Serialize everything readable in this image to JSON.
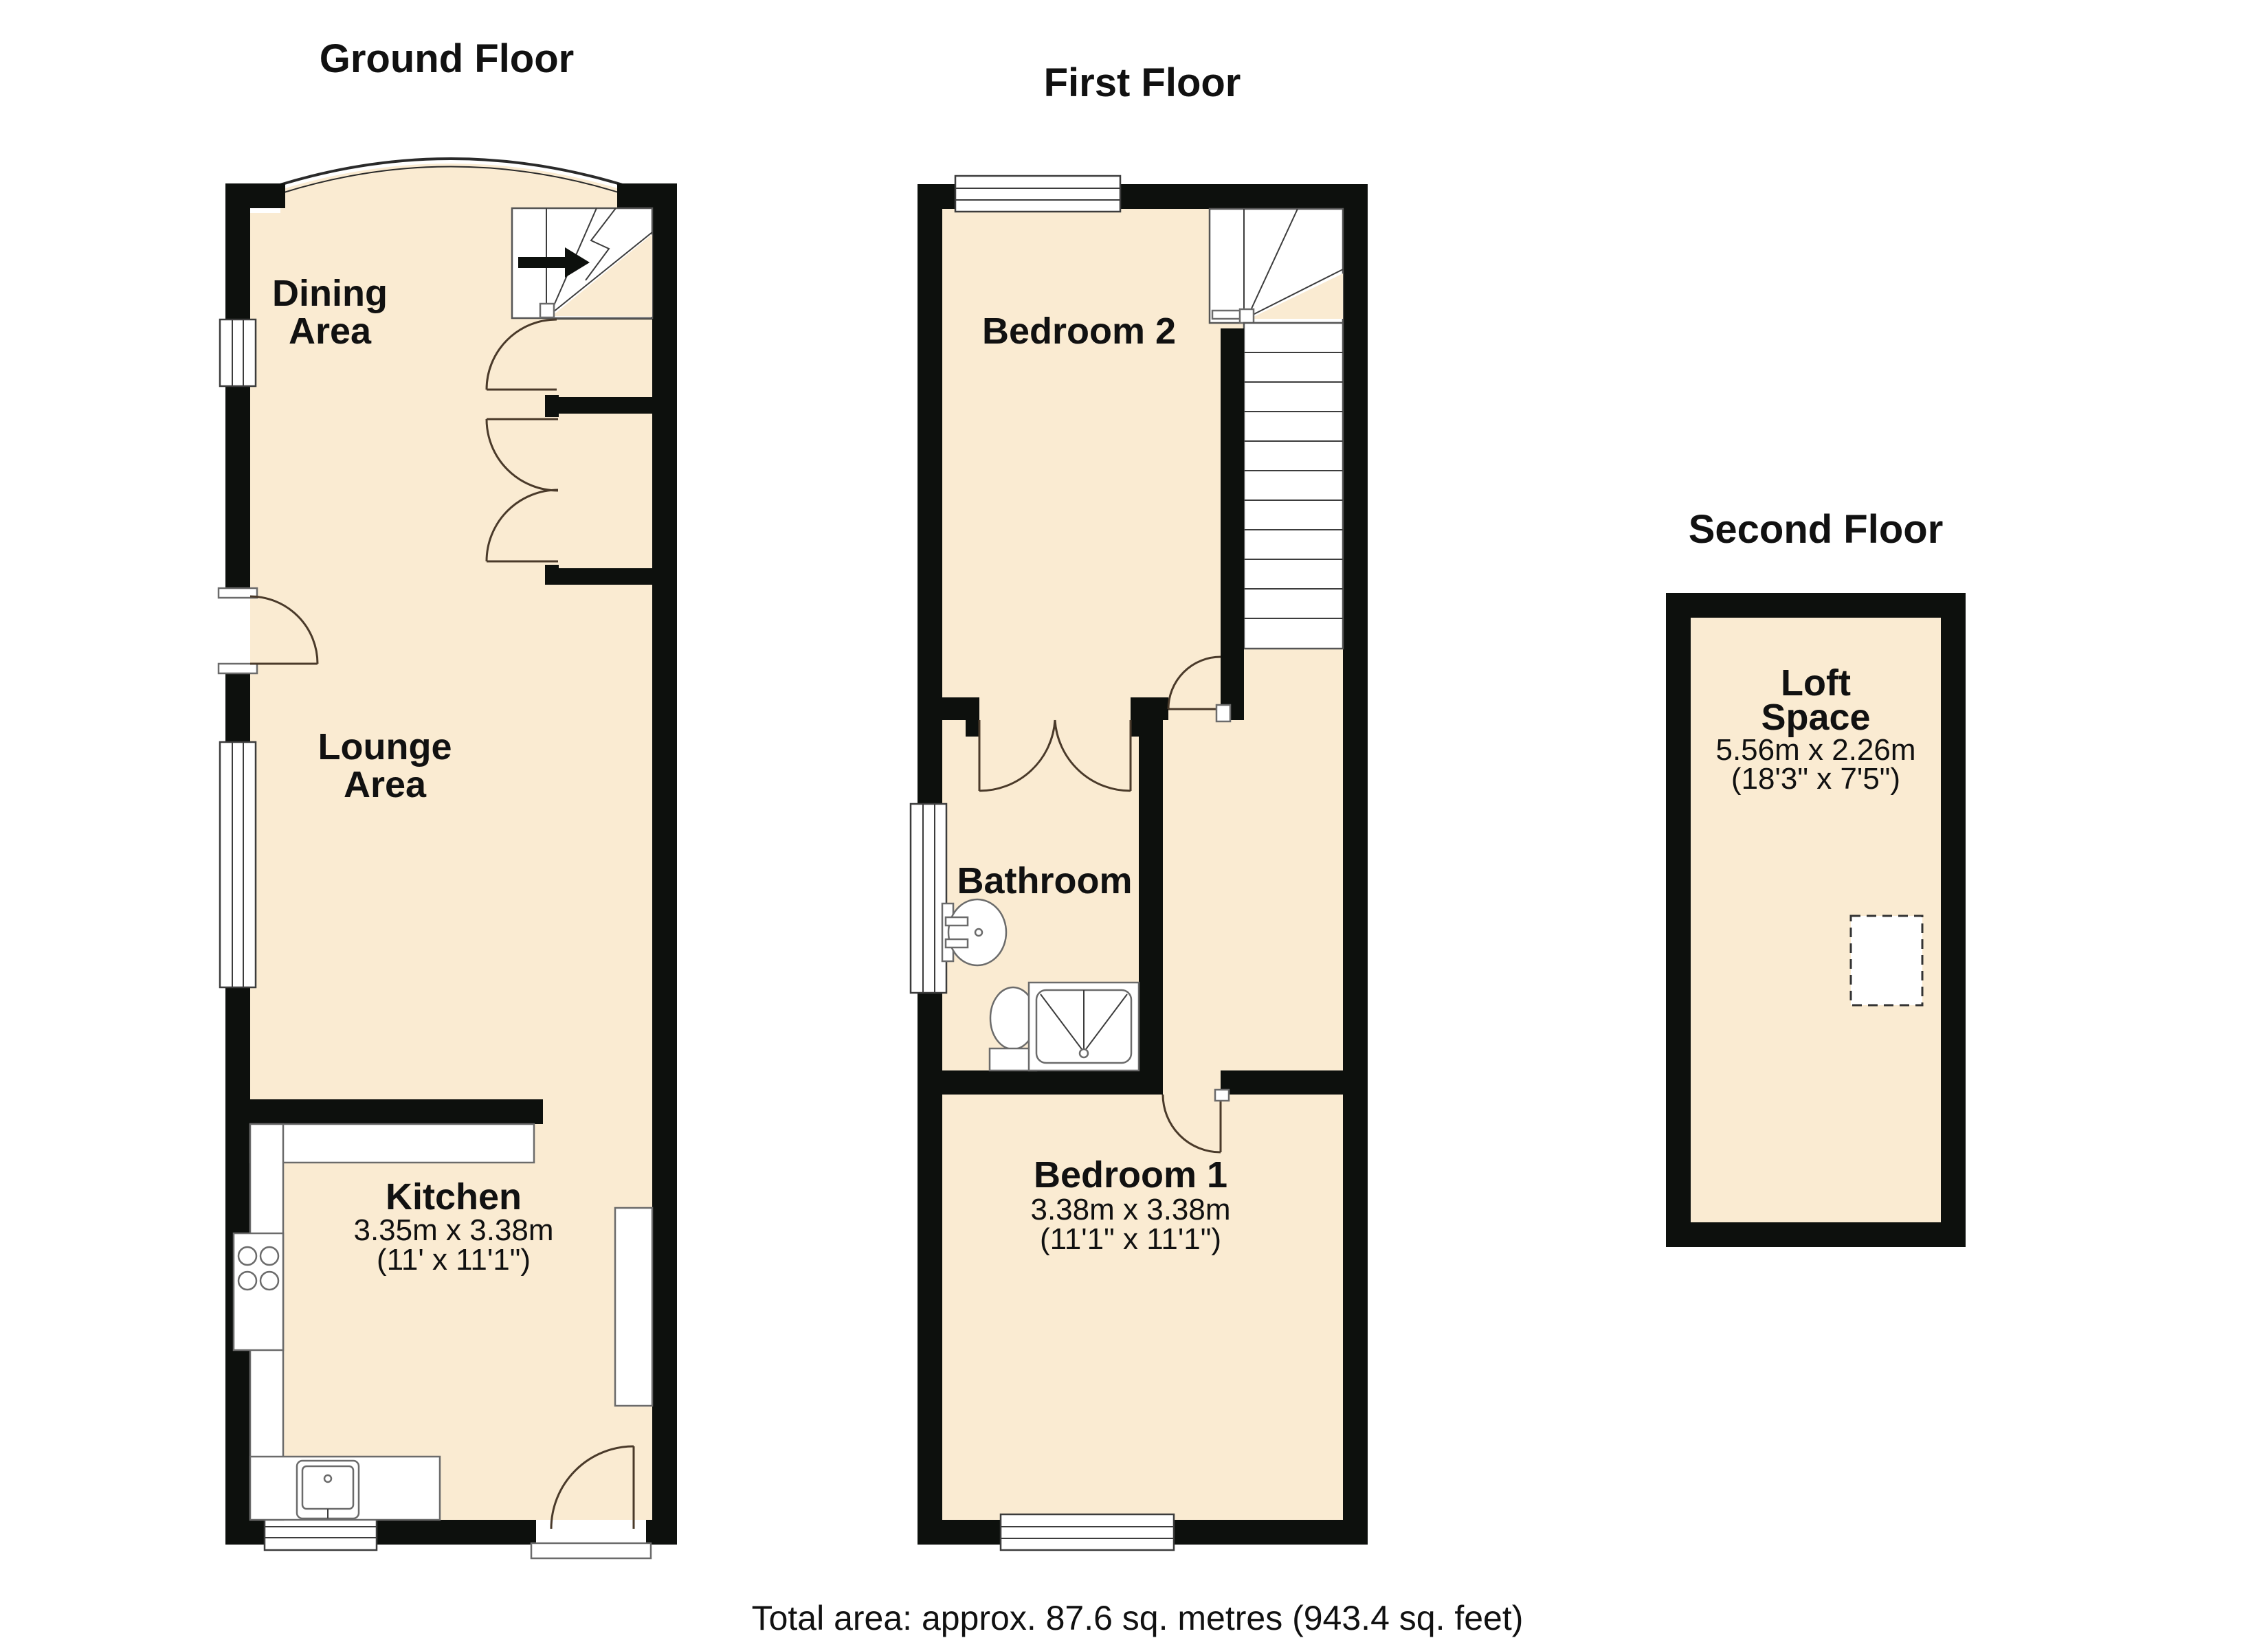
{
  "colors": {
    "room_fill": "#faebd2",
    "wall": "#0d100d",
    "background": "#ffffff"
  },
  "floors": {
    "ground": {
      "title": "Ground Floor",
      "rooms": {
        "dining": {
          "name_line1": "Dining",
          "name_line2": "Area"
        },
        "lounge": {
          "name_line1": "Lounge",
          "name_line2": "Area"
        },
        "kitchen": {
          "name": "Kitchen",
          "dim_metric": "3.35m x 3.38m",
          "dim_imperial": "(11' x 11'1\")"
        }
      }
    },
    "first": {
      "title": "First Floor",
      "rooms": {
        "bedroom2": {
          "name": "Bedroom 2"
        },
        "bathroom": {
          "name": "Bathroom"
        },
        "bedroom1": {
          "name": "Bedroom 1",
          "dim_metric": "3.38m x 3.38m",
          "dim_imperial": "(11'1\" x 11'1\")"
        }
      }
    },
    "second": {
      "title": "Second Floor",
      "rooms": {
        "loft": {
          "name_line1": "Loft",
          "name_line2": "Space",
          "dim_metric": "5.56m x 2.26m",
          "dim_imperial": "(18'3\" x 7'5\")"
        }
      }
    }
  },
  "footer": {
    "total_area": "Total area: approx. 87.6 sq. metres (943.4 sq. feet)"
  }
}
